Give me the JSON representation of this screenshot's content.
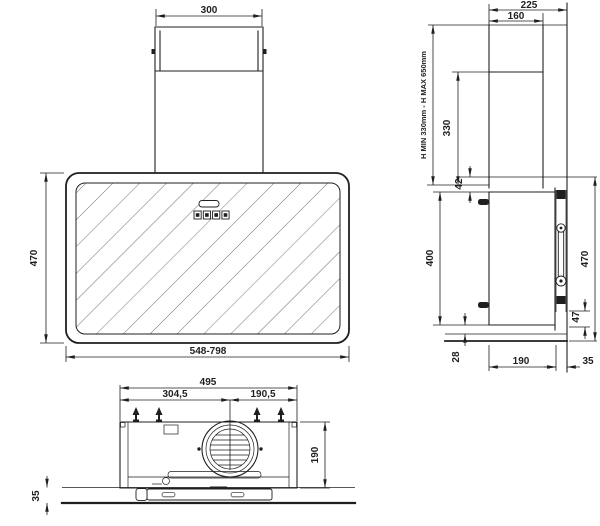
{
  "drawing": {
    "front": {
      "chimney_width": "300",
      "height": "470",
      "width_range": "548-798"
    },
    "side": {
      "total_depth": "225",
      "chimney_depth": "160",
      "height_range": "H MIN 330mm - H MAX 650mm",
      "chimney_extension": "330",
      "top_offset": "42",
      "body_height": "400",
      "overall_height": "470",
      "bracket_height": "47",
      "bottom_offset": "28",
      "body_depth": "190",
      "wall_gap": "35"
    },
    "bottom": {
      "body_width": "495",
      "vent_from_left": "304,5",
      "vent_from_right": "190,5",
      "body_depth": "190",
      "glass_offset": "35"
    }
  },
  "colors": {
    "line": "#1f1f1f",
    "hatch": "#707070",
    "background": "#ffffff"
  }
}
